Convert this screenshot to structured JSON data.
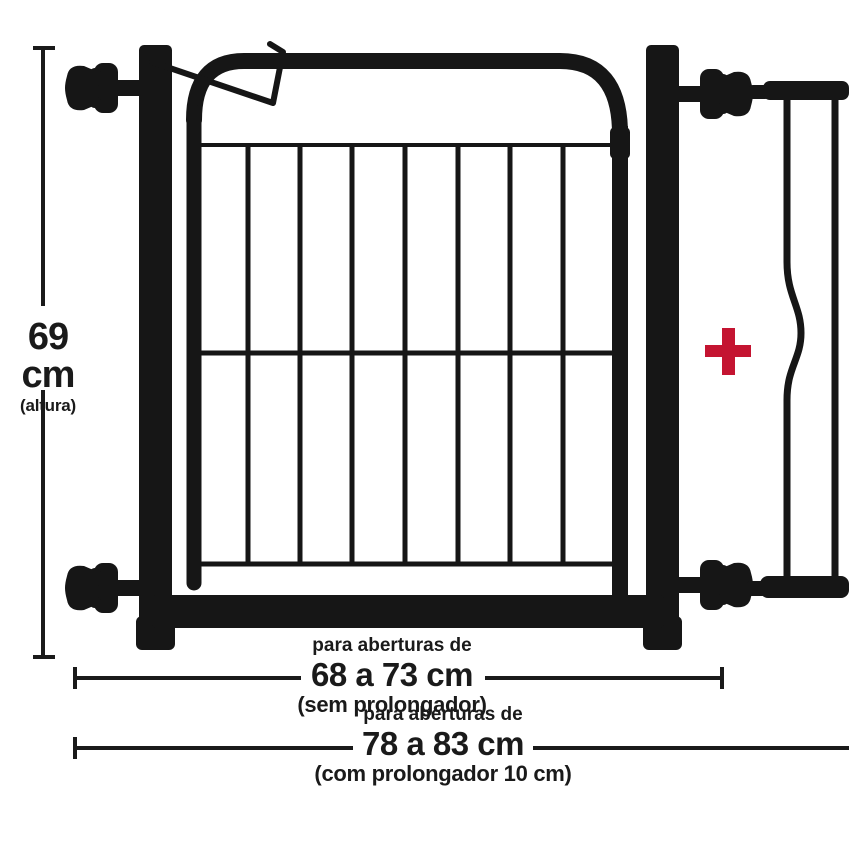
{
  "diagram": {
    "type": "product-dimension-diagram",
    "subject": "pressure-mounted safety gate with extension panel",
    "dimensions": {
      "height": {
        "value": "69 cm",
        "qualifier": "(altura)"
      },
      "opening_without_extension": {
        "intro": "para aberturas de",
        "value": "68 a 73 cm",
        "qualifier": "(sem prolongador)"
      },
      "opening_with_extension": {
        "intro": "para aberturas de",
        "value": "78 a 83 cm",
        "qualifier": "(com prolongador 10 cm)"
      }
    },
    "icons": {
      "plus_symbol": "+",
      "pressure_knob_count": 4
    },
    "colors": {
      "metal_black": "#161616",
      "annotation_text": "#1a1a1a",
      "dimension_line": "#1a1a1a",
      "accent_red_plus": "#c41431",
      "background": "#ffffff"
    }
  }
}
